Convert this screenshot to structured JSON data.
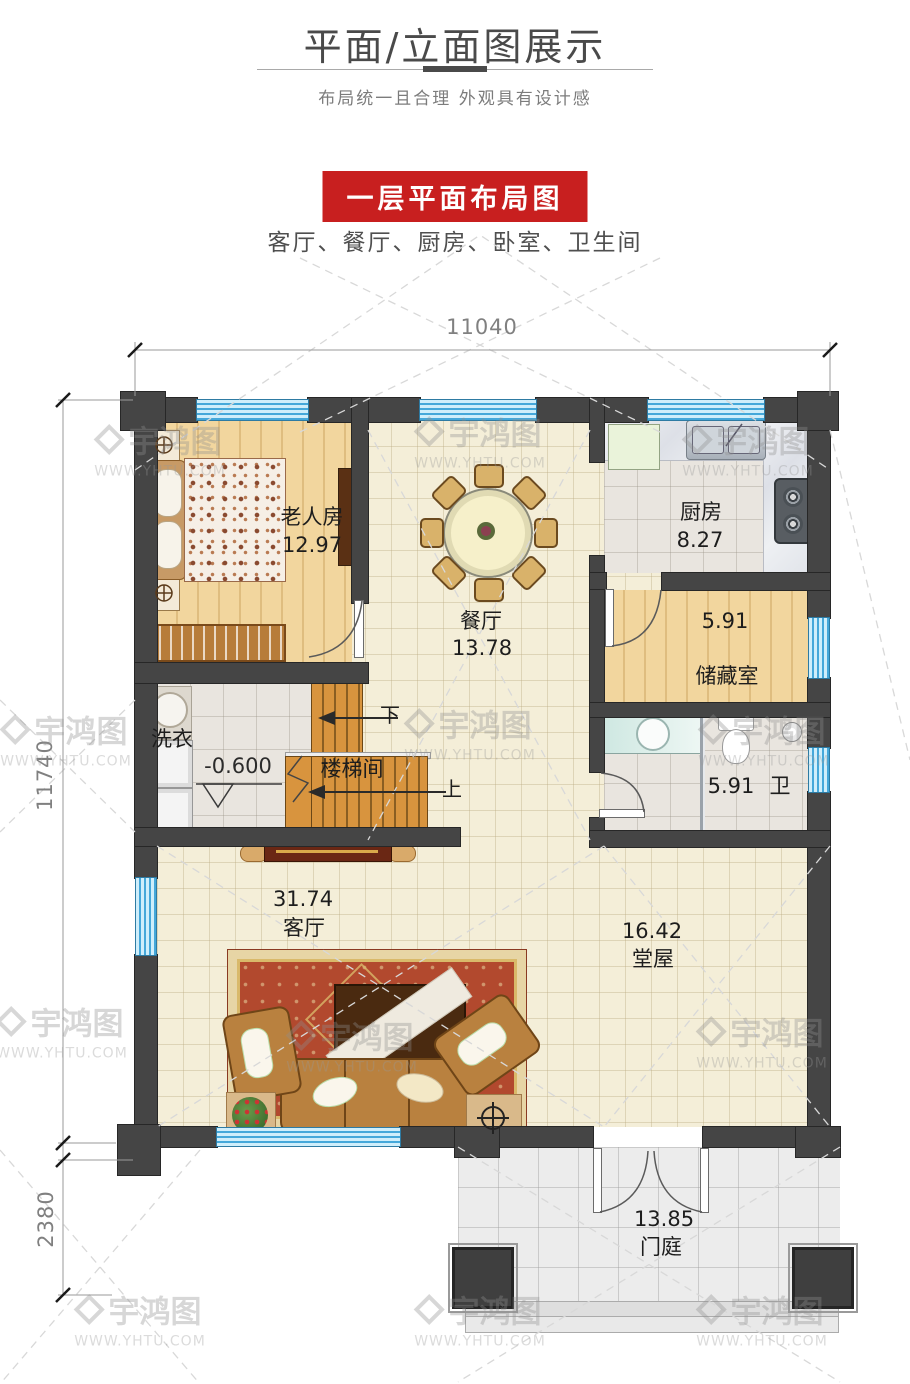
{
  "header": {
    "title": "平面/立面图展示",
    "subtitle": "布局统一且合理  外观具有设计感"
  },
  "section": {
    "banner": "一层平面布局图",
    "rooms_line": "客厅、餐厅、厨房、卧室、卫生间"
  },
  "dimensions": {
    "top_width": "11040",
    "left_height": "11740",
    "porch_depth": "2380"
  },
  "rooms": {
    "bedroom": {
      "name": "老人房",
      "area": "12.97"
    },
    "dining": {
      "name": "餐厅",
      "area": "13.78"
    },
    "kitchen": {
      "name": "厨房",
      "area": "8.27"
    },
    "storage": {
      "name": "储藏室",
      "area": "5.91"
    },
    "bathroom": {
      "name": "卫",
      "area": "5.91"
    },
    "laundry": {
      "name": "洗衣"
    },
    "stairwell": {
      "name": "楼梯间",
      "down_label": "下",
      "up_label": "上",
      "floor_level": "-0.600"
    },
    "living": {
      "name": "客厅",
      "area": "31.74"
    },
    "hall": {
      "name": "堂屋",
      "area": "16.42"
    },
    "porch": {
      "name": "门庭",
      "area": "13.85"
    }
  },
  "watermark": {
    "brand": "宇鸿图",
    "url": "WWW.YHTU.COM"
  },
  "colors": {
    "banner_red": "#c81f1f",
    "wall_dark": "#454545",
    "window_blue": "#8fd2f0",
    "stair_wood": "#d8943e",
    "rug_red": "#b2492e"
  }
}
